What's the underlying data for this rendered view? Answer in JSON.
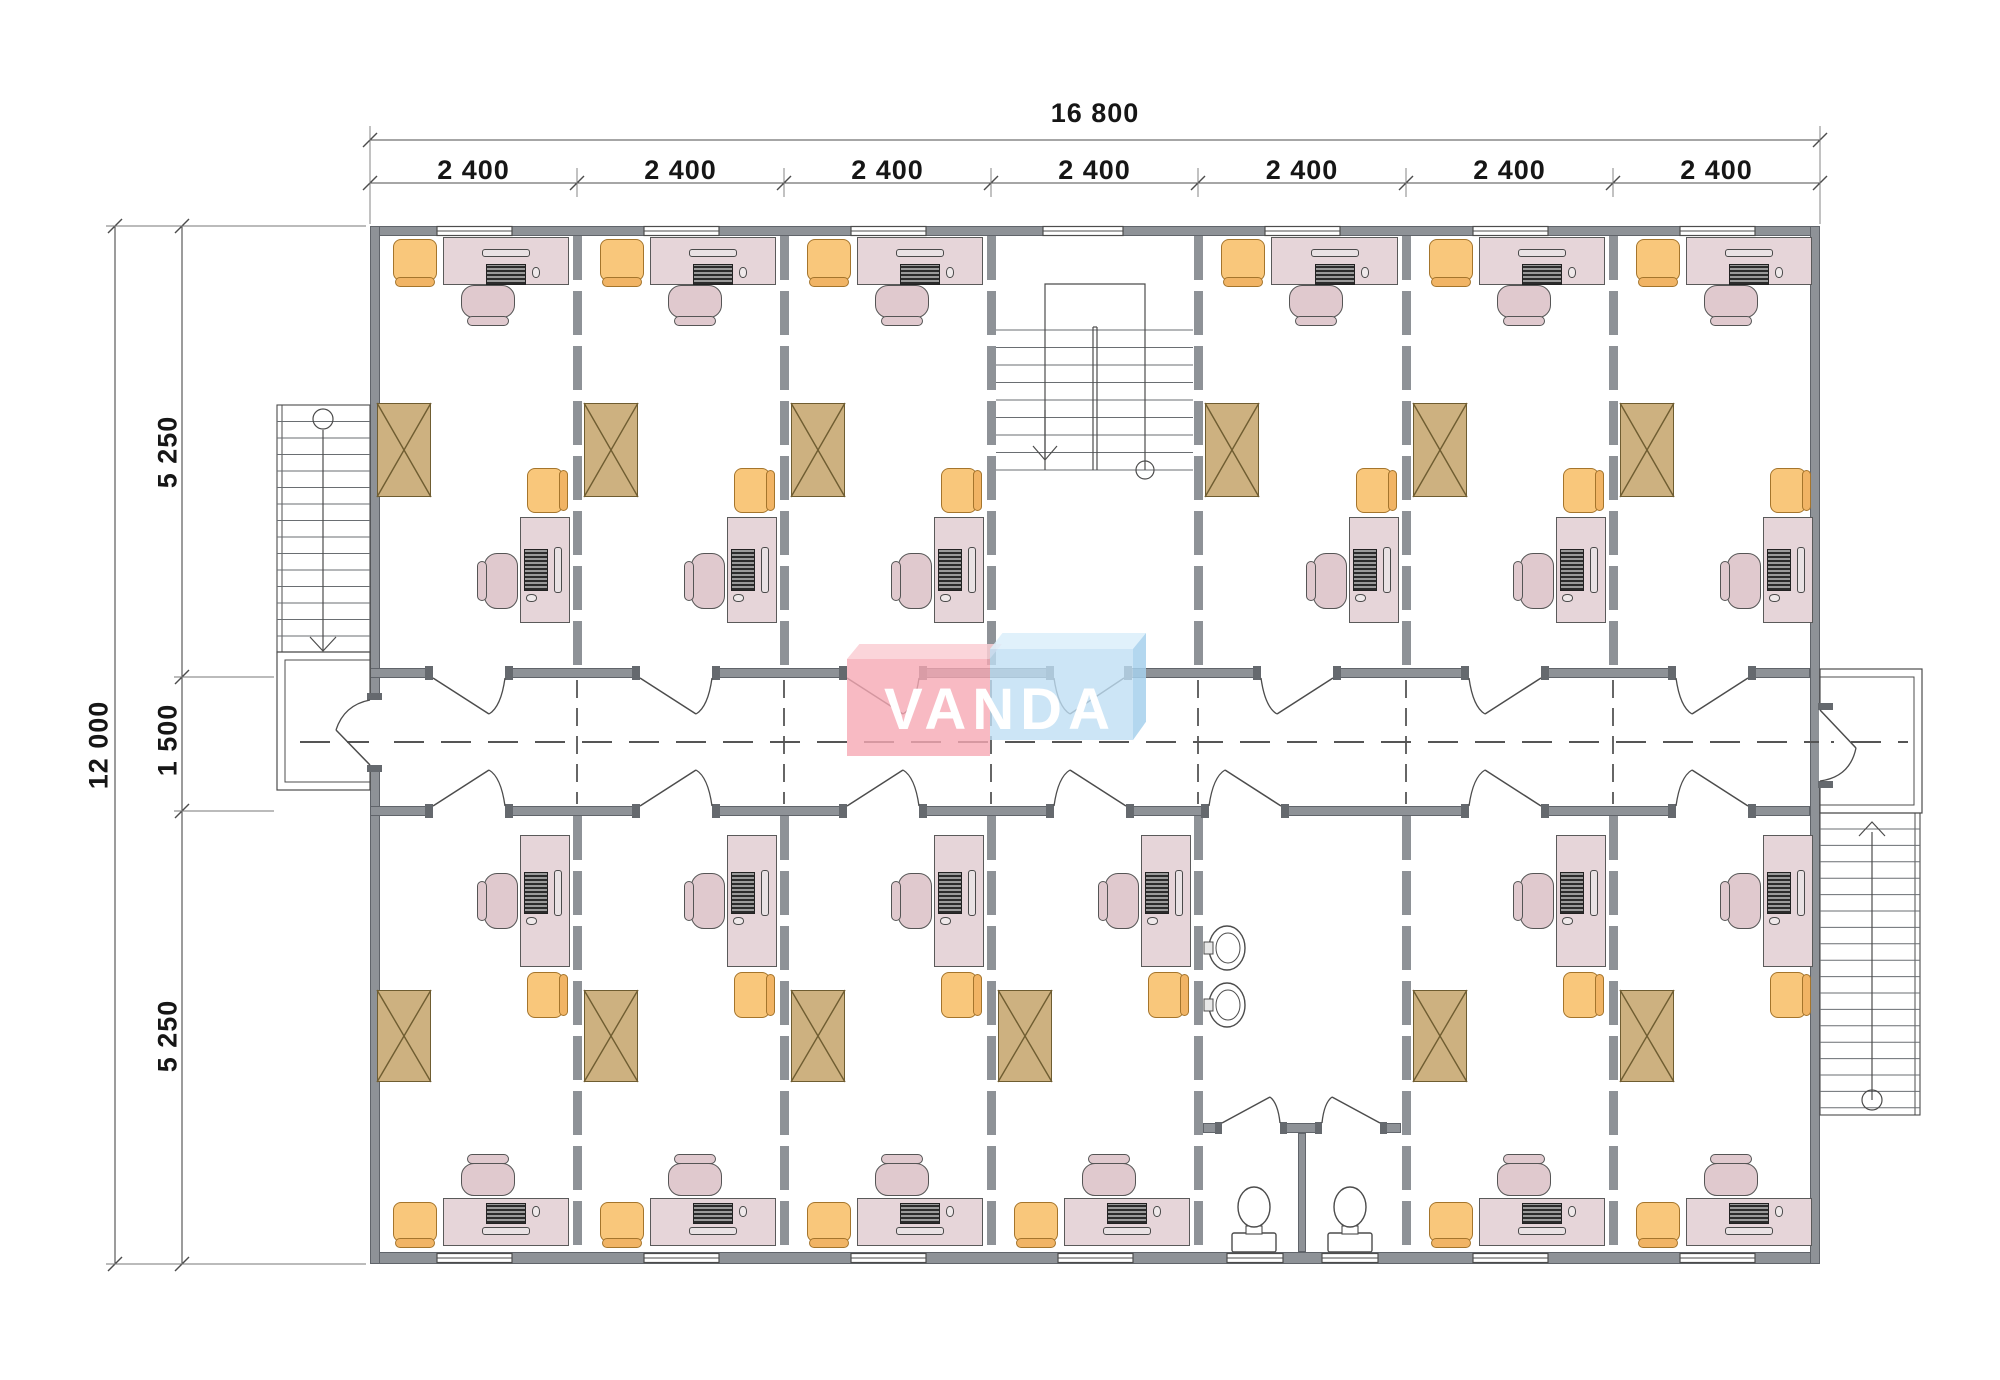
{
  "title": "Modular office building floor plan",
  "logo": {
    "text": "VANDA"
  },
  "dimensions": {
    "top_total": "16 800",
    "bay_labels": [
      "2 400",
      "2 400",
      "2 400",
      "2 400",
      "2 400",
      "2 400",
      "2 400"
    ],
    "left_total": "12 000",
    "left_segments": [
      "5 250",
      "1 500",
      "5 250"
    ]
  },
  "layout": {
    "bays": 7,
    "top_rooms": [
      "office",
      "office",
      "office",
      "staircase",
      "office",
      "office",
      "office"
    ],
    "bottom_rooms": [
      "office",
      "office",
      "office",
      "office",
      "washroom",
      "office",
      "office"
    ],
    "corridor": "central corridor with dashed centerline",
    "exterior": [
      "left-exterior-stair-with-landing",
      "right-exterior-stair-with-landing"
    ]
  },
  "washroom": {
    "sinks": 2,
    "toilet_stalls": 2,
    "toilets": 2
  },
  "office_furniture": [
    "desk-with-computer",
    "desk-with-computer",
    "office-chair",
    "office-chair",
    "armchair",
    "armchair",
    "storage-cabinet"
  ],
  "colors": {
    "wall": "#8e9297",
    "wall_stub": "#65696e",
    "line": "#4c4c4c",
    "desk": "#e6d5d9",
    "chair": "#e0c9ce",
    "armchair": "#f9c77b",
    "cabinet": "#cdb180",
    "logo_pink": "rgba(246,169,180,0.8)",
    "logo_pink_top": "rgba(250,206,212,0.85)",
    "logo_blue": "rgba(191,223,244,0.8)",
    "logo_blue_top": "rgba(219,238,250,0.85)",
    "logo_blue_side": "rgba(166,208,236,0.85)"
  }
}
